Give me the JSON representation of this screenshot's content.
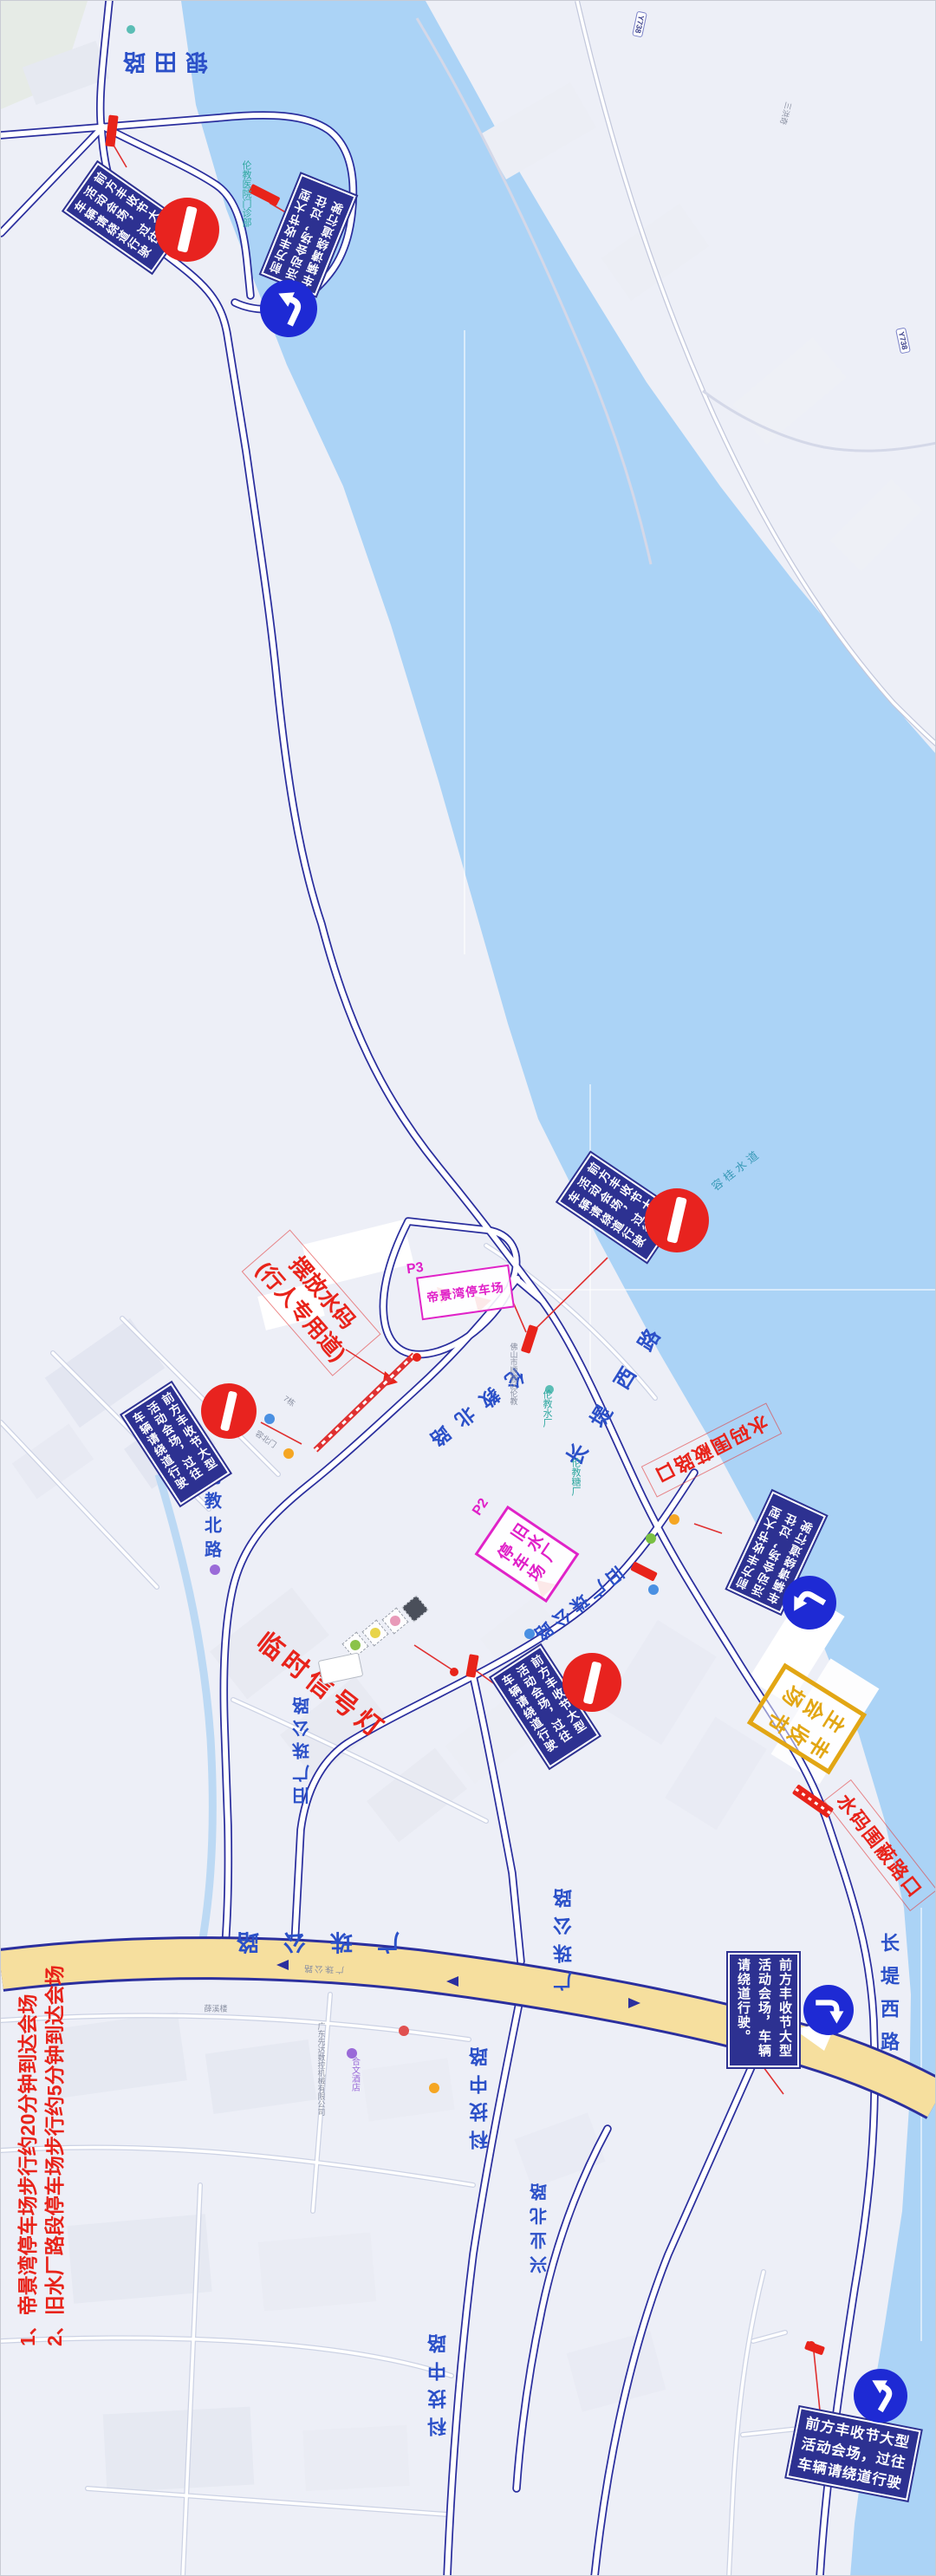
{
  "signs": {
    "detour_a": {
      "col1": "前方丰收节大型",
      "col2": "活动会场，过往",
      "col3": "车辆请绕道行驶"
    },
    "detour_b": {
      "col1": "前方丰收节大型",
      "col2": "活动会场，车辆",
      "col3": "请绕道行驶。"
    }
  },
  "annotations": {
    "water_barrier_line1": "摆放水码",
    "water_barrier_line2": "(行人专用道)",
    "temp_signal": "临时信号灯",
    "closed_junction_1": "水码围蔽路口",
    "closed_junction_2": "水码围蔽路口"
  },
  "parking": {
    "p3_tag": "P3",
    "p3_name": "帝景湾停车场",
    "p2_tag": "P2",
    "p2_col1": "旧水厂",
    "p2_col2": "停车场"
  },
  "venue": {
    "col1": "丰收节",
    "col2": "主会场"
  },
  "notes": {
    "line1": "1、帝景湾停车场步行约20分钟到达会场",
    "line2": "2、旧水厂路段停车场步行约5分钟到达会场"
  },
  "roads": {
    "yintian": "银田路",
    "changdi_1": "长堤西路",
    "changdi_2": "长堤西路",
    "lunjiao_1": "伦教北路",
    "lunjiao_2": "伦教北路",
    "jiuguangzhu_1": "旧广珠公路",
    "jiuguangzhu_2": "旧广珠公路",
    "guangzhu_1": "广珠公路",
    "guangzhu_2": "广珠公路",
    "guangzhu_small": "广珠公路",
    "keji_1": "科技中路",
    "keji_2": "科技中路",
    "xingye": "兴业北路",
    "y738_a": "Y738",
    "y738_b": "Y738"
  },
  "water": {
    "name": "容桂水道"
  },
  "pois": {
    "hospital": "伦教医院门诊部",
    "north_gate": "容北门",
    "building7": "7栋",
    "shunde_gov": "佛山市顺德区伦教",
    "waterworks": "伦教水厂",
    "sugar_mill": "伦教糖厂",
    "machinery": "广东先达数控机械有限公司",
    "hotel": "合文酒店",
    "xuexilou": "薛溪楼",
    "sanhongqi": "三洪奇"
  },
  "colors": {
    "water": "#abd3f6",
    "land": "#edeff7",
    "road_casing": "#2b2f9e",
    "expressway_fill": "#f6df9e",
    "sign_blue": "#2d3191",
    "arrow_blue": "#1e2ad4",
    "alert_red": "#e8231a",
    "magenta": "#e023c8",
    "venue_yellow": "#e2a614",
    "road_label_blue": "#2b50c8"
  }
}
